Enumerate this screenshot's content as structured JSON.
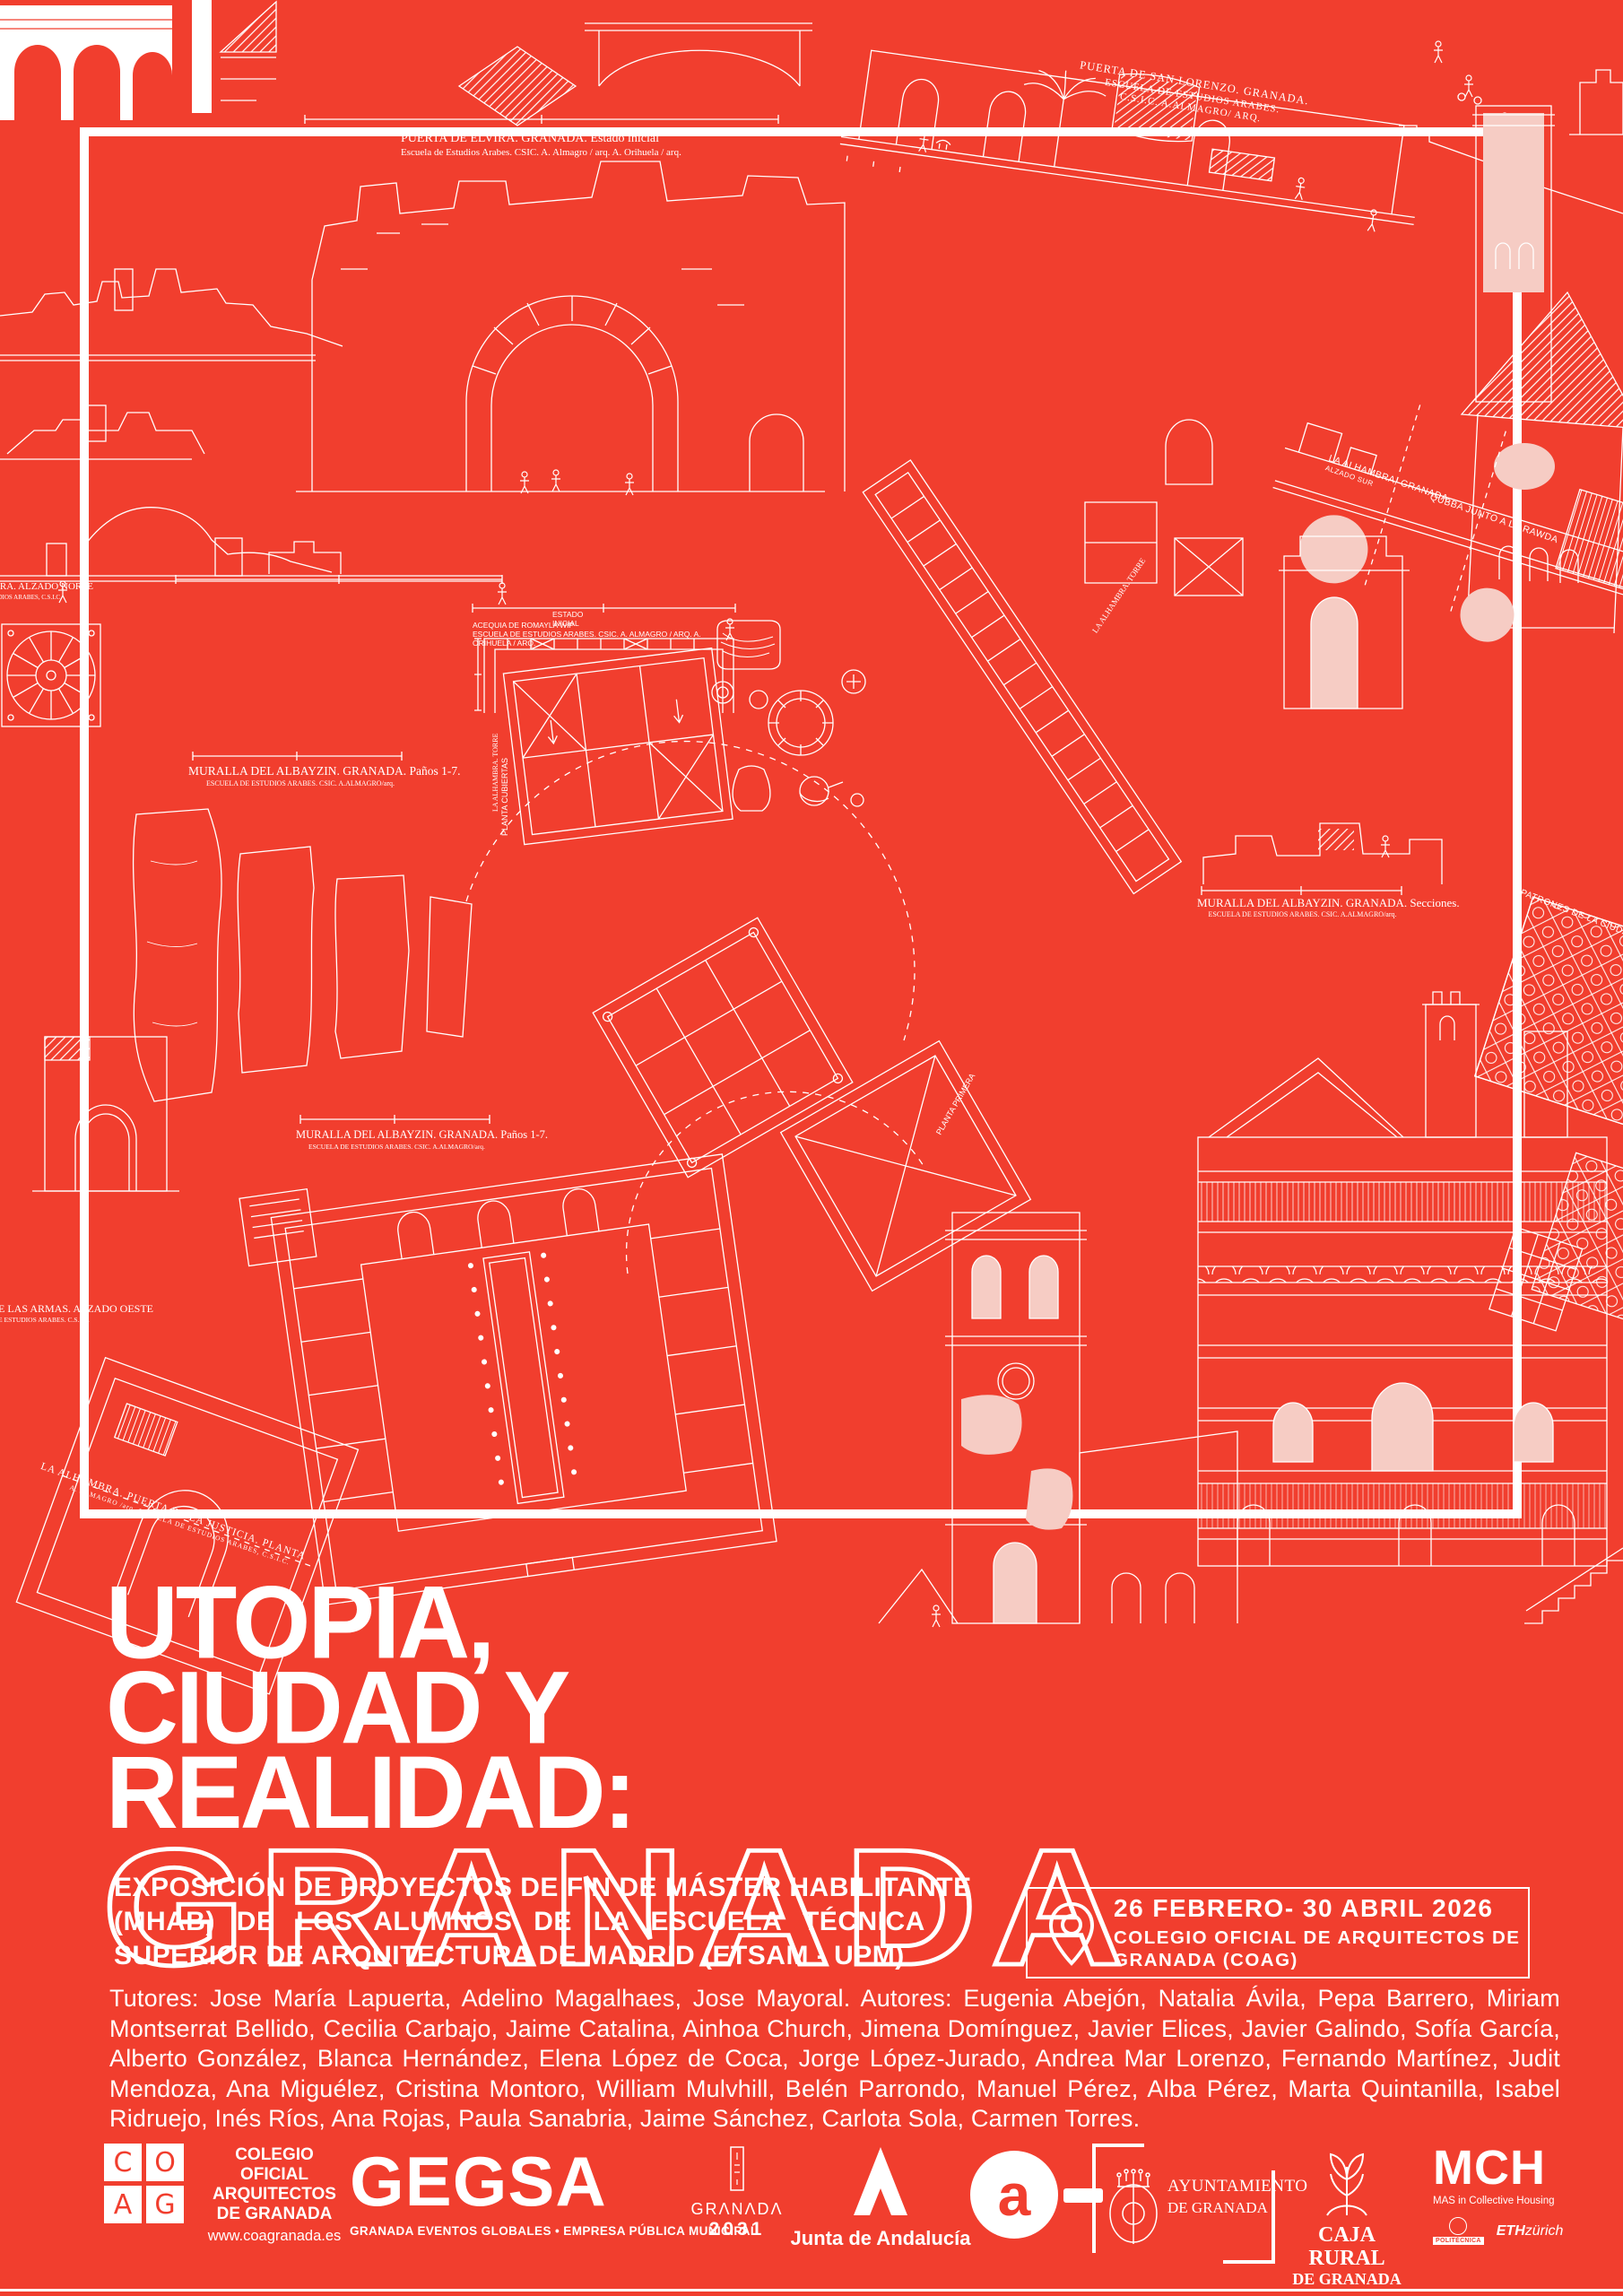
{
  "colors": {
    "background": "#F13E2E",
    "ink": "#FFFFFF",
    "pale_fill": "#F6CCC4"
  },
  "title": {
    "lines": [
      "UTOPIA,",
      "CIUDAD Y",
      "REALIDAD:"
    ],
    "highlight": "GRANADA"
  },
  "subtitle": {
    "lines": [
      "EXPOSICIÓN DE PROYECTOS DE FIN DE MÁSTER HABILITANTE",
      "(MHAB) DE LOS ALUMNOS DE LA ESCUELA TÉCNICA",
      "SUPERIOR DE ARQUITECTURA DE MADRID (ETSAM - UPM)"
    ]
  },
  "event": {
    "dates": "26 FEBRERO- 30 ABRIL 2026",
    "venue_lines": [
      "COLEGIO OFICIAL DE ARQUITECTOS DE",
      "GRANADA (COAG)"
    ]
  },
  "credits": "Tutores: Jose María Lapuerta, Adelino Magalhaes, Jose Mayoral. Autores: Eugenia Abejón, Natalia Ávila, Pepa Barrero, Miriam Montserrat Bellido, Cecilia Carbajo, Jaime Catalina, Ainhoa Church, Jimena Domínguez, Javier Elices, Javier Galindo, Sofía García, Alberto González, Blanca Hernández, Elena López de Coca, Jorge López-Jurado, Andrea Mar Lorenzo, Fernando Martínez, Judit Mendoza, Ana Miguélez, Cristina Montoro, William Mulvhill, Belén Parrondo, Manuel Pérez, Alba Pérez, Marta Quintanilla, Isabel Ridruejo, Inés Ríos, Ana Rojas, Paula Sanabria, Jaime Sánchez, Carlota Sola, Carmen Torres.",
  "captions": {
    "elvira_title": "PUERTA DE ELVIRA. GRANADA.  Estado inicial",
    "elvira_sub": "Escuela de Estudios Arabes. CSIC. A. Almagro / arq. A. Orihuela / arq.",
    "san_lorenzo_l1": "PUERTA DE SAN LORENZO. GRANADA.",
    "san_lorenzo_l2": "ESCUELA DE ESTUDIOS ARABES.",
    "san_lorenzo_l3": "C.S.I.C. A.ALMAGRO/ ARQ.",
    "muralla_panos": "MURALLA DEL ALBAYZIN. GRANADA. Paños 1-7.",
    "muralla_secciones": "MURALLA DEL ALBAYZIN. GRANADA. Secciones.",
    "escuela_sub": "ESCUELA DE ESTUDIOS ARABES. CSIC. A.ALMAGRO/arq.",
    "armas_title": "PUERTA DE LAS ARMAS. ALZADO OESTE",
    "armas_sub": "/arq. ESCUELA DE ESTUDIOS ARABES. C.S.I.C.",
    "alzado_norte": "LA ALHAMBRA.  ALZADO NORTE",
    "alzado_norte_sub": "ESCUELA DE ESTUDIOS ARABES, C.S.I.C.",
    "estado_l1": "ESTADO",
    "estado_l2": "INICIAL",
    "acequia_l1": "ACEQUIA DE ROMAYLA WIP",
    "acequia_l2": "ESCUELA DE ESTUDIOS ARABES. CSIC. A. ALMAGRO / ARQ. A.",
    "acequia_l3": "ORIHUELA / ARQ.",
    "justicia": "LA ALHAMBRA. PUERTA DE LA JUSTICIA. PLANTA",
    "justicia_sub": "A. ALMAGRO /arq. ESCUELA DE ESTUDIOS ARABES, C.S.I.C.",
    "patrones": "PATRONES DE LA CIUDAD",
    "alhambra_granada": "LA ALHAMBRA, GRANADA.",
    "alzado_sur": "ALZADO SUR",
    "qubba": "QUBBA JUNTO A LA RAWDA",
    "torre": "LA ALHAMBRA. TORRE",
    "planta_cubiertas": "PLANTA CUBIERTAS",
    "planta_primera": "PLANTA PRIMERA"
  },
  "footer": {
    "coag": {
      "letters": [
        "C",
        "O",
        "A",
        "G"
      ],
      "org_lines": [
        "COLEGIO",
        "OFICIAL",
        "ARQUITECTOS"
      ],
      "de": "DE ",
      "granada_bold": "GRANADA",
      "url": "www.coagranada.es"
    },
    "gegsa": {
      "wordmark": "GEGSA",
      "tagline": "GRANADA EVENTOS GLOBALES • EMPRESA PÚBLICA MUNICIPAL"
    },
    "granada2031": {
      "name": "GRΛNΛDΛ",
      "year": "2031"
    },
    "junta": {
      "label": "Junta de Andalucía"
    },
    "a_guion": {
      "letter": "a"
    },
    "ayuntamiento": {
      "line1": "AYUNTAMIENTO",
      "line2": "DE GRANADA"
    },
    "caja_rural": {
      "line1": "CAJA RURAL",
      "line2": "DE GRANADA"
    },
    "mch": {
      "name": "MCH",
      "tagline": "MAS in Collective Housing",
      "politecnica": "POLITÉCNICA",
      "eth_bold": "ETH",
      "eth_rest": "zürich"
    }
  }
}
